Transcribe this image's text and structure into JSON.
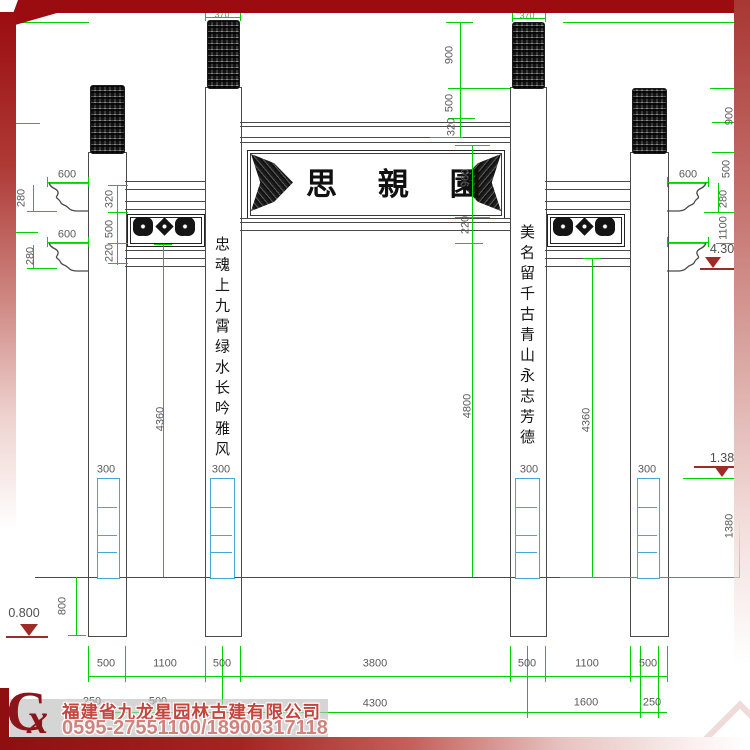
{
  "drawing": {
    "plaque_text": "思 親 園",
    "left_column_text": "忠魂上九霄绿水长吟雅风",
    "right_column_text": "美名留千古青山永志芳德",
    "dim_labels": [
      {
        "t": "370",
        "x": 222,
        "y": 15,
        "rot": 0,
        "cls": "sm"
      },
      {
        "t": "370",
        "x": 527,
        "y": 16,
        "rot": 0,
        "cls": "sm"
      },
      {
        "t": "900",
        "x": 450,
        "y": 55,
        "rot": 1
      },
      {
        "t": "500",
        "x": 450,
        "y": 103,
        "rot": 1
      },
      {
        "t": "320",
        "x": 452,
        "y": 127,
        "rot": 1
      },
      {
        "t": "960",
        "x": 466,
        "y": 178,
        "rot": 1
      },
      {
        "t": "220",
        "x": 466,
        "y": 225,
        "rot": 1
      },
      {
        "t": "4800",
        "x": 468,
        "y": 406,
        "rot": 1
      },
      {
        "t": "600",
        "x": 67,
        "y": 175,
        "rot": 0
      },
      {
        "t": "280",
        "x": 22,
        "y": 198,
        "rot": 1
      },
      {
        "t": "600",
        "x": 67,
        "y": 235,
        "rot": 0
      },
      {
        "t": "280",
        "x": 31,
        "y": 256,
        "rot": 1
      },
      {
        "t": "320",
        "x": 110,
        "y": 199,
        "rot": 1
      },
      {
        "t": "500",
        "x": 110,
        "y": 229,
        "rot": 1
      },
      {
        "t": "220",
        "x": 110,
        "y": 253,
        "rot": 1
      },
      {
        "t": "4360",
        "x": 161,
        "y": 419,
        "rot": 1
      },
      {
        "t": "4360",
        "x": 587,
        "y": 420,
        "rot": 1
      },
      {
        "t": "600",
        "x": 688,
        "y": 175,
        "rot": 0
      },
      {
        "t": "280",
        "x": 724,
        "y": 199,
        "rot": 1
      },
      {
        "t": "1100",
        "x": 724,
        "y": 228,
        "rot": 1
      },
      {
        "t": "900",
        "x": 730,
        "y": 116,
        "rot": 1
      },
      {
        "t": "500",
        "x": 727,
        "y": 169,
        "rot": 1
      },
      {
        "t": "300",
        "x": 106,
        "y": 470,
        "rot": 0
      },
      {
        "t": "300",
        "x": 221,
        "y": 470,
        "rot": 0
      },
      {
        "t": "300",
        "x": 529,
        "y": 470,
        "rot": 0
      },
      {
        "t": "300",
        "x": 647,
        "y": 470,
        "rot": 0
      },
      {
        "t": "800",
        "x": 63,
        "y": 606,
        "rot": 1
      },
      {
        "t": "1380",
        "x": 730,
        "y": 526,
        "rot": 1
      },
      {
        "t": "500",
        "x": 106,
        "y": 664,
        "rot": 0
      },
      {
        "t": "1100",
        "x": 165,
        "y": 664,
        "rot": 0
      },
      {
        "t": "500",
        "x": 222,
        "y": 664,
        "rot": 0
      },
      {
        "t": "3800",
        "x": 375,
        "y": 664,
        "rot": 0
      },
      {
        "t": "500",
        "x": 527,
        "y": 664,
        "rot": 0
      },
      {
        "t": "1100",
        "x": 587,
        "y": 664,
        "rot": 0
      },
      {
        "t": "500",
        "x": 648,
        "y": 664,
        "rot": 0
      },
      {
        "t": "250",
        "x": 92,
        "y": 702,
        "rot": 0
      },
      {
        "t": "500",
        "x": 158,
        "y": 702,
        "rot": 0
      },
      {
        "t": "4300",
        "x": 375,
        "y": 704,
        "rot": 0
      },
      {
        "t": "1600",
        "x": 586,
        "y": 703,
        "rot": 0
      },
      {
        "t": "250",
        "x": 652,
        "y": 703,
        "rot": 0
      },
      {
        "t": "4.30",
        "x": 722,
        "y": 249,
        "rot": 0,
        "cls": "lvl"
      },
      {
        "t": "1.38",
        "x": 722,
        "y": 458,
        "rot": 0,
        "cls": "lvl"
      },
      {
        "t": "0.800",
        "x": 24,
        "y": 613,
        "rot": 0,
        "cls": "lvl"
      }
    ]
  },
  "footer": {
    "logo_c": "C",
    "logo_x": "x",
    "company": "福建省九龙星园林古建有限公司",
    "phone": "0595-27551100/18900317118"
  },
  "colors": {
    "dim_green": "#00d200",
    "line_dark": "#4a4a4a",
    "foundation_cyan": "#45a7d6",
    "border_red": "#9b0c10",
    "brand_red": "#c4443e"
  }
}
